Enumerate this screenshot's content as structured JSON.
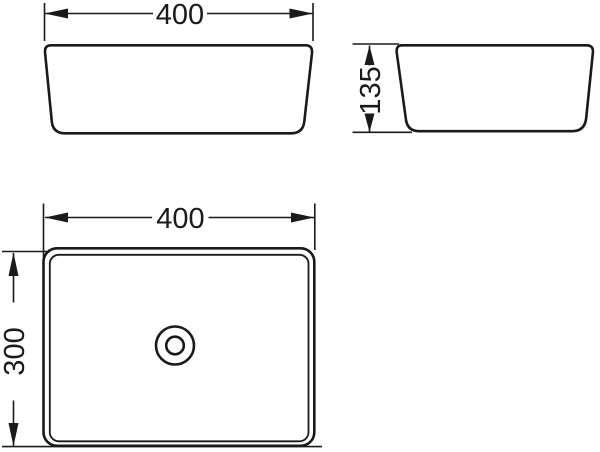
{
  "colors": {
    "line": "#1a1a1a",
    "background": "#ffffff"
  },
  "drawing_type": "sink-basin-technical-dimension-drawing",
  "dimensions": {
    "front_width": "400",
    "side_height": "135",
    "top_width": "400",
    "top_depth": "300"
  }
}
